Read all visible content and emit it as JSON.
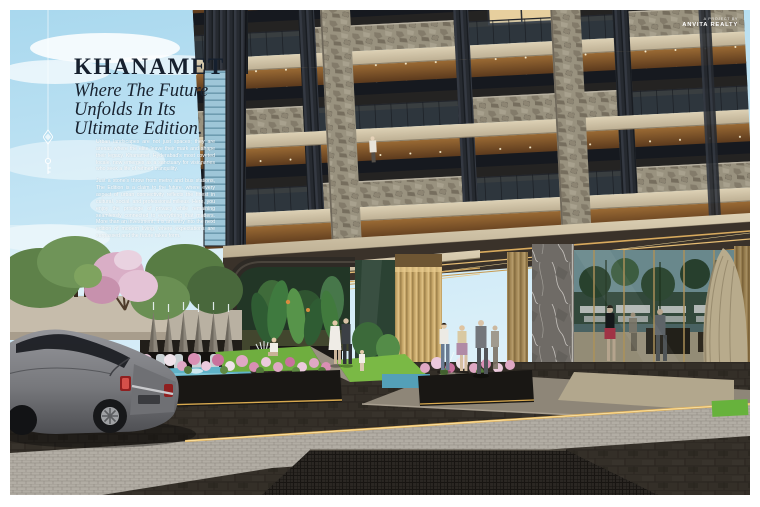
{
  "hero": {
    "title": "KHANAMET",
    "subtitle_lines": [
      "Where The Future",
      "Unfolds In Its",
      "Ultimate Edition."
    ],
    "paragraphs": {
      "p1": "Urban landscapes are not just spaces; they are arenas where the elite leave their mark and shape their legacy. Khanamet, Hyderabad's most coveted locale, now emerges as a sanctuary for visionaries who seek a life of refined tranquility.",
      "p2": "Just a stone's throw from metro and bus stations, The Edition is a claim to the future, where every aspect of urban connectivity reflects the finest in cultural, social, and professional milieus. Here, you enjoy the privilege of privacy while remaining seamlessly connected to everything that matters. More than an investment, it is an entry into the next edition of modern living, where expectations are surpassed and the future takes form."
    }
  },
  "brand": {
    "pretext": "A PROJECT BY",
    "name": "ANVITA REALTY"
  },
  "palette": {
    "sky": "#bfe2f2",
    "title_ink": "#16202e",
    "slab_beige": "#d0c3a7",
    "stone_grey": "#97907f",
    "wood_soffit": "#8a5a2e",
    "louver_dark": "#272b31",
    "gold_column": "#c5a568",
    "led_gold": "#e8c06a",
    "glass_dark": "#1c2026",
    "lobby_reflection": "#3a5244",
    "grass_green": "#6fae3f",
    "pool_blue": "#5fb2c8",
    "flower_pink": "#dfa8c4",
    "pavement_dark": "#3b362f",
    "cobble_light": "#b2ada4",
    "car_silver": "#8e8f91",
    "taillight_red": "#b03030"
  }
}
